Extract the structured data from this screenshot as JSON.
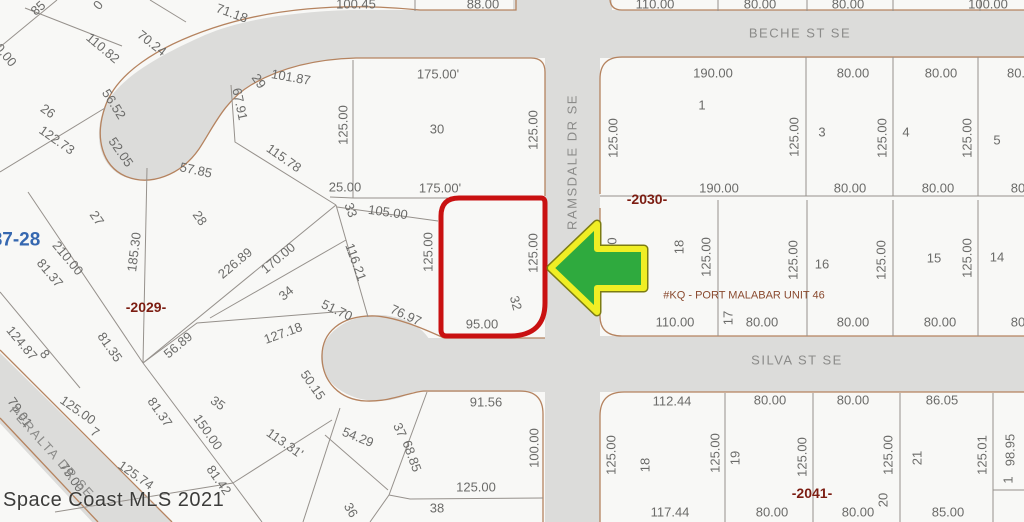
{
  "map": {
    "watermark": "Space Coast MLS 2021",
    "unit_label": "#KQ - PORT MALABAR UNIT 46",
    "page_ref": "87-28",
    "subject_lot": "32",
    "colors": {
      "road_fill": "#dcdcda",
      "road_edge": "#b5835f",
      "parcel_line": "#96918c",
      "highlight_red": "#c91111",
      "arrow_green": "#2faa3e",
      "arrow_yellow": "#f0ee24"
    },
    "streets": [
      {
        "name": "BECHE ST SE",
        "x": 800,
        "y": 33,
        "r": 0
      },
      {
        "name": "RAMSDALE DR SE",
        "x": 572,
        "y": 162,
        "r": -90
      },
      {
        "name": "SILVA ST SE",
        "x": 797,
        "y": 360,
        "r": 0
      },
      {
        "name": "PERALTA DR SE",
        "x": 52,
        "y": 452,
        "r": 48
      }
    ],
    "labels": [
      {
        "t": "85",
        "x": 38,
        "y": 8,
        "r": -42
      },
      {
        "t": "0.00",
        "x": 6,
        "y": 55,
        "r": 50
      },
      {
        "t": "0",
        "x": 98,
        "y": 5,
        "r": -50
      },
      {
        "t": "110.82",
        "x": 103,
        "y": 48,
        "r": 40
      },
      {
        "t": "70.24",
        "x": 152,
        "y": 43,
        "r": 38
      },
      {
        "t": "71.18",
        "x": 232,
        "y": 13,
        "r": 20
      },
      {
        "t": "100.45",
        "x": 356,
        "y": 4
      },
      {
        "t": "88.00",
        "x": 483,
        "y": 4
      },
      {
        "t": "110.00",
        "x": 655,
        "y": 4
      },
      {
        "t": "80.00",
        "x": 760,
        "y": 4
      },
      {
        "t": "80.00",
        "x": 848,
        "y": 4
      },
      {
        "t": "100.00",
        "x": 988,
        "y": 4
      },
      {
        "t": "26",
        "x": 48,
        "y": 111,
        "r": 35
      },
      {
        "t": "122.73",
        "x": 57,
        "y": 140,
        "r": 35
      },
      {
        "t": "56.52",
        "x": 114,
        "y": 104,
        "r": 58
      },
      {
        "t": "52.05",
        "x": 121,
        "y": 152,
        "r": 55
      },
      {
        "t": "57.85",
        "x": 196,
        "y": 170,
        "r": 12
      },
      {
        "t": "67.91",
        "x": 240,
        "y": 104,
        "r": 78
      },
      {
        "t": "29",
        "x": 259,
        "y": 81,
        "r": 55
      },
      {
        "t": "101.87",
        "x": 291,
        "y": 77,
        "r": 10
      },
      {
        "t": "115.78",
        "x": 284,
        "y": 158,
        "r": 35
      },
      {
        "t": "125.00",
        "x": 343,
        "y": 125,
        "r": -90
      },
      {
        "t": "30",
        "x": 437,
        "y": 129
      },
      {
        "t": "125.00",
        "x": 533,
        "y": 130,
        "r": -90
      },
      {
        "t": "175.00'",
        "x": 438,
        "y": 74
      },
      {
        "t": "25.00",
        "x": 345,
        "y": 187
      },
      {
        "t": "175.00'",
        "x": 440,
        "y": 188
      },
      {
        "t": "33",
        "x": 351,
        "y": 210,
        "r": 70
      },
      {
        "t": "105.00",
        "x": 388,
        "y": 212,
        "r": 8
      },
      {
        "t": "27",
        "x": 97,
        "y": 218,
        "r": 55
      },
      {
        "t": "28",
        "x": 200,
        "y": 218,
        "r": 55
      },
      {
        "t": "87-28",
        "x": 16,
        "y": 240,
        "c": "blue",
        "b": true,
        "s": 19
      },
      {
        "t": "185.30",
        "x": 134,
        "y": 252,
        "r": -83
      },
      {
        "t": "210.00",
        "x": 68,
        "y": 258,
        "r": 50
      },
      {
        "t": "81.37",
        "x": 50,
        "y": 273,
        "r": 50
      },
      {
        "t": "226.89",
        "x": 235,
        "y": 263,
        "r": -40
      },
      {
        "t": "170.00",
        "x": 278,
        "y": 258,
        "r": -40
      },
      {
        "t": "34",
        "x": 286,
        "y": 293,
        "r": -40
      },
      {
        "t": "-2029-",
        "x": 146,
        "y": 307,
        "c": "red",
        "b": true,
        "s": 14
      },
      {
        "t": "124.87",
        "x": 22,
        "y": 343,
        "r": 50
      },
      {
        "t": "8",
        "x": 45,
        "y": 354,
        "r": 50
      },
      {
        "t": "81.35",
        "x": 110,
        "y": 347,
        "r": 55
      },
      {
        "t": "56.89",
        "x": 178,
        "y": 345,
        "r": -40
      },
      {
        "t": "127.18",
        "x": 283,
        "y": 333,
        "r": -20
      },
      {
        "t": "116.21",
        "x": 356,
        "y": 262,
        "r": 70
      },
      {
        "t": "51.70",
        "x": 337,
        "y": 310,
        "r": 25
      },
      {
        "t": "76.97",
        "x": 406,
        "y": 315,
        "r": 25
      },
      {
        "t": "125.00",
        "x": 428,
        "y": 252,
        "r": -90
      },
      {
        "t": "125.00",
        "x": 533,
        "y": 253,
        "r": -90
      },
      {
        "t": "32",
        "x": 516,
        "y": 303,
        "r": 75
      },
      {
        "t": "95.00",
        "x": 482,
        "y": 324
      },
      {
        "t": "79.01",
        "x": 20,
        "y": 412,
        "r": 55
      },
      {
        "t": "125.00",
        "x": 78,
        "y": 410,
        "r": 35
      },
      {
        "t": "7",
        "x": 95,
        "y": 432,
        "r": 35
      },
      {
        "t": "81.37",
        "x": 160,
        "y": 412,
        "r": 55
      },
      {
        "t": "35",
        "x": 218,
        "y": 403,
        "r": 35
      },
      {
        "t": "150.00",
        "x": 208,
        "y": 432,
        "r": 55
      },
      {
        "t": "113.31'",
        "x": 285,
        "y": 443,
        "r": 35
      },
      {
        "t": "79.00",
        "x": 72,
        "y": 477,
        "r": 55
      },
      {
        "t": "125.74",
        "x": 136,
        "y": 475,
        "r": 35
      },
      {
        "t": "81.42",
        "x": 219,
        "y": 480,
        "r": 55
      },
      {
        "t": "50.15",
        "x": 313,
        "y": 385,
        "r": 55
      },
      {
        "t": "54.29",
        "x": 358,
        "y": 437,
        "r": 22
      },
      {
        "t": "37",
        "x": 400,
        "y": 430,
        "r": 65
      },
      {
        "t": "68.85",
        "x": 412,
        "y": 456,
        "r": 70
      },
      {
        "t": "36",
        "x": 351,
        "y": 510,
        "r": 60
      },
      {
        "t": "38",
        "x": 437,
        "y": 508
      },
      {
        "t": "91.56",
        "x": 486,
        "y": 402
      },
      {
        "t": "100.00",
        "x": 534,
        "y": 448,
        "r": -90
      },
      {
        "t": "125.00",
        "x": 476,
        "y": 487
      },
      {
        "t": "190.00",
        "x": 713,
        "y": 73
      },
      {
        "t": "80.00",
        "x": 853,
        "y": 73
      },
      {
        "t": "80.00",
        "x": 941,
        "y": 73
      },
      {
        "t": "80.",
        "x": 1016,
        "y": 73
      },
      {
        "t": "1",
        "x": 702,
        "y": 105
      },
      {
        "t": "125.00",
        "x": 613,
        "y": 138,
        "r": -90
      },
      {
        "t": "125.00",
        "x": 794,
        "y": 137,
        "r": -90
      },
      {
        "t": "3",
        "x": 822,
        "y": 132
      },
      {
        "t": "125.00",
        "x": 882,
        "y": 138,
        "r": -90
      },
      {
        "t": "4",
        "x": 906,
        "y": 132
      },
      {
        "t": "125.00",
        "x": 967,
        "y": 138,
        "r": -90
      },
      {
        "t": "5",
        "x": 997,
        "y": 140
      },
      {
        "t": "190.00",
        "x": 719,
        "y": 188
      },
      {
        "t": "80.00",
        "x": 850,
        "y": 188
      },
      {
        "t": "80.00",
        "x": 938,
        "y": 188
      },
      {
        "t": "80",
        "x": 1018,
        "y": 188
      },
      {
        "t": "-2030-",
        "x": 647,
        "y": 199,
        "c": "red",
        "b": true,
        "s": 14
      },
      {
        "t": "0",
        "x": 612,
        "y": 241,
        "r": -90
      },
      {
        "t": "18",
        "x": 679,
        "y": 247,
        "r": -90
      },
      {
        "t": "125.00",
        "x": 706,
        "y": 257,
        "r": -90
      },
      {
        "t": "16",
        "x": 822,
        "y": 264
      },
      {
        "t": "125.00",
        "x": 793,
        "y": 260,
        "r": -90
      },
      {
        "t": "15",
        "x": 934,
        "y": 258
      },
      {
        "t": "125.00",
        "x": 881,
        "y": 260,
        "r": -90
      },
      {
        "t": "14",
        "x": 997,
        "y": 257
      },
      {
        "t": "125.00",
        "x": 967,
        "y": 258,
        "r": -90
      },
      {
        "t": "#KQ - PORT MALABAR UNIT 46",
        "x": 744,
        "y": 296,
        "c": "kq",
        "s": 11
      },
      {
        "t": "110.00",
        "x": 675,
        "y": 322
      },
      {
        "t": "17",
        "x": 728,
        "y": 318,
        "r": -90
      },
      {
        "t": "80.00",
        "x": 762,
        "y": 322
      },
      {
        "t": "80.00",
        "x": 853,
        "y": 322
      },
      {
        "t": "80.00",
        "x": 940,
        "y": 322
      },
      {
        "t": "80",
        "x": 1018,
        "y": 322
      },
      {
        "t": "112.44",
        "x": 672,
        "y": 401
      },
      {
        "t": "80.00",
        "x": 770,
        "y": 400
      },
      {
        "t": "80.00",
        "x": 853,
        "y": 400
      },
      {
        "t": "86.05",
        "x": 942,
        "y": 400
      },
      {
        "t": "125.00",
        "x": 611,
        "y": 455,
        "r": -90
      },
      {
        "t": "18",
        "x": 645,
        "y": 465,
        "r": -90
      },
      {
        "t": "125.00",
        "x": 715,
        "y": 453,
        "r": -90
      },
      {
        "t": "19",
        "x": 735,
        "y": 458,
        "r": -90
      },
      {
        "t": "125.00",
        "x": 802,
        "y": 457,
        "r": -90
      },
      {
        "t": "125.00",
        "x": 888,
        "y": 455,
        "r": -90
      },
      {
        "t": "21",
        "x": 917,
        "y": 458,
        "r": -90
      },
      {
        "t": "125.01",
        "x": 982,
        "y": 455,
        "r": -90
      },
      {
        "t": "98.95",
        "x": 1010,
        "y": 450,
        "r": -90
      },
      {
        "t": "1",
        "x": 1008,
        "y": 480,
        "r": -90
      },
      {
        "t": "-2041-",
        "x": 812,
        "y": 493,
        "c": "red",
        "b": true,
        "s": 14
      },
      {
        "t": "20",
        "x": 883,
        "y": 500,
        "r": -90
      },
      {
        "t": "117.44",
        "x": 670,
        "y": 512
      },
      {
        "t": "80.00",
        "x": 772,
        "y": 512
      },
      {
        "t": "80.00",
        "x": 858,
        "y": 512
      },
      {
        "t": "85.00",
        "x": 948,
        "y": 512
      }
    ]
  }
}
